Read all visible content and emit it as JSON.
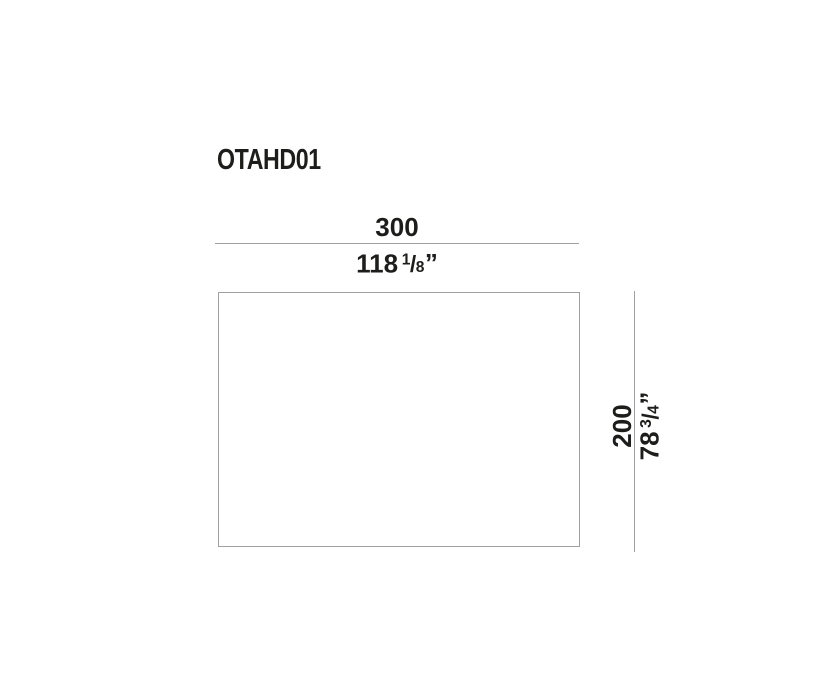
{
  "title": "OTAHD01",
  "dimensions": {
    "width": {
      "orientation": "horizontal",
      "metric": "300",
      "imperial_whole": "118",
      "imperial_numerator": "1",
      "imperial_denominator": "8",
      "imperial_unit": "”"
    },
    "height": {
      "orientation": "vertical",
      "metric": "200",
      "imperial_whole": "78",
      "imperial_numerator": "3",
      "imperial_denominator": "4",
      "imperial_unit": "”"
    }
  },
  "colors": {
    "text": "#1d1d1b",
    "line": "#a0a09e",
    "background": "#ffffff"
  }
}
